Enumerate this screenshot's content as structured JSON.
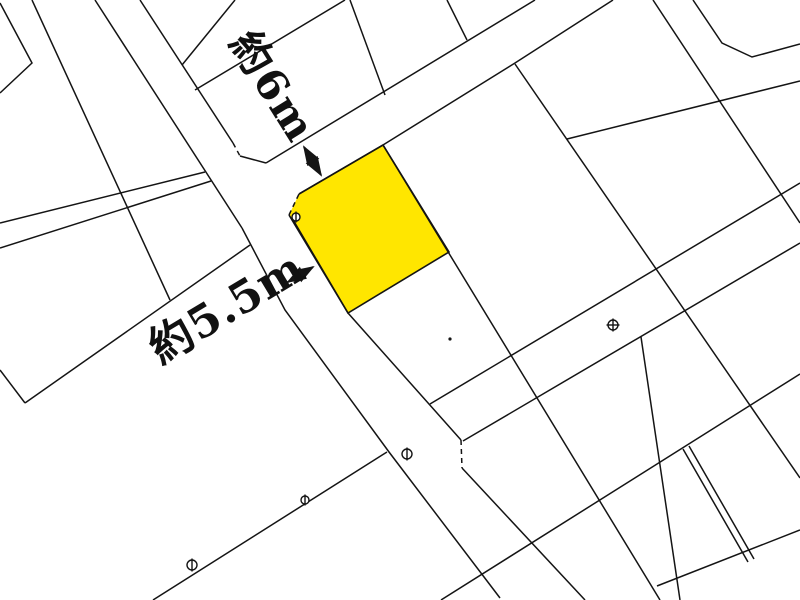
{
  "map": {
    "background_color": "#ffffff",
    "boundary_line_color": "#141414",
    "highlight_parcel": {
      "name": "subject-parcel",
      "fill_color": "#ffe600"
    },
    "annotations": {
      "road_width_top": {
        "label": "約6m"
      },
      "road_width_left": {
        "label": "約5.5m"
      }
    },
    "survey_markers": [
      {
        "type": "circle-vertical-bar",
        "x": 296,
        "y": 217,
        "r": 4
      },
      {
        "type": "circle-vertical-bar",
        "x": 407,
        "y": 454,
        "r": 5
      },
      {
        "type": "circle-vertical-bar",
        "x": 192,
        "y": 565,
        "r": 5
      },
      {
        "type": "circle-vertical-bar",
        "x": 305,
        "y": 500,
        "r": 4
      },
      {
        "type": "circle-cross",
        "x": 613,
        "y": 325,
        "r": 5
      },
      {
        "type": "dot",
        "x": 450,
        "y": 339,
        "r": 1.6
      }
    ]
  }
}
